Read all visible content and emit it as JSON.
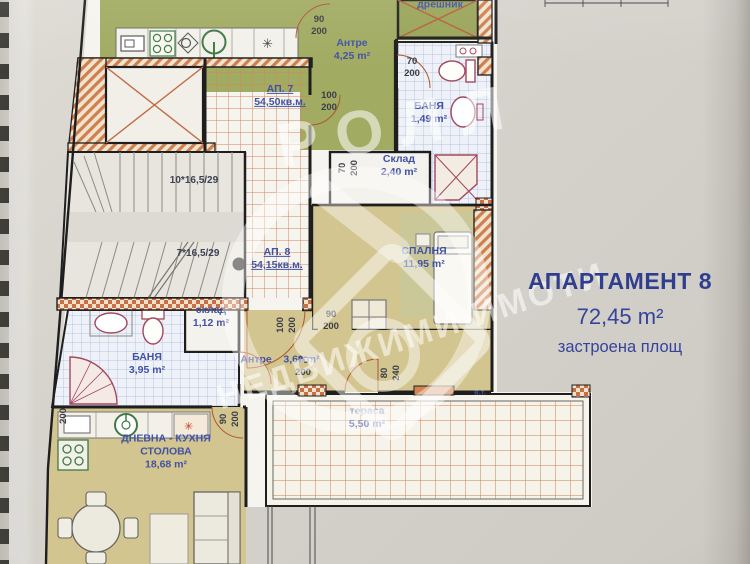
{
  "title_block": {
    "title": "АПАРТАМЕНТ 8",
    "area": "72,45 m²",
    "caption": "застроена площ"
  },
  "watermark": {
    "brand": "РОЛЛ",
    "tagline": "НЕДВИЖИМИ ИМОТИ"
  },
  "plan": {
    "icons": {
      "asterisk": "✳"
    },
    "room_labels": [
      {
        "name": "label-room-antre-ap7",
        "lines": [
          "Антре",
          "4,25 m²"
        ],
        "x": 352,
        "y": 50
      },
      {
        "name": "label-room-dreshnik",
        "lines": [
          "дрешник"
        ],
        "x": 440,
        "y": 5
      },
      {
        "name": "label-room-banya-ap7",
        "lines": [
          "БАНЯ",
          "1,49 m²"
        ],
        "x": 429,
        "y": 113
      },
      {
        "name": "label-ap7",
        "lines": [
          "АП. 7",
          "54,50кв.м."
        ],
        "x": 280,
        "y": 96,
        "u": true
      },
      {
        "name": "label-room-sklad-240",
        "lines": [
          "Склад",
          "2,40 m²"
        ],
        "x": 399,
        "y": 166
      },
      {
        "name": "label-ap8",
        "lines": [
          "АП. 8",
          "54,15кв.м."
        ],
        "x": 277,
        "y": 259,
        "u": true
      },
      {
        "name": "label-room-spalnya",
        "lines": [
          "СПАЛНЯ",
          "11,95 m²"
        ],
        "x": 424,
        "y": 258
      },
      {
        "name": "label-room-sklad-112",
        "lines": [
          "склад",
          "1,12 m²"
        ],
        "x": 211,
        "y": 317
      },
      {
        "name": "label-room-banya-ap8",
        "lines": [
          "БАНЯ",
          "3,95 m²"
        ],
        "x": 147,
        "y": 364
      },
      {
        "name": "label-room-antre-ap8",
        "lines": [
          "Антре    3,60 m²"
        ],
        "x": 280,
        "y": 360
      },
      {
        "name": "label-room-terasa",
        "lines": [
          "тераса",
          "5,50 m²"
        ],
        "x": 367,
        "y": 418,
        "faint": true
      },
      {
        "name": "label-room-dnevna",
        "lines": [
          "ДНЕВНА - КУХНЯ",
          "СТОЛОВА",
          "18,68 m²"
        ],
        "x": 166,
        "y": 452
      },
      {
        "name": "label-water-point",
        "lines": [
          "в.т."
        ],
        "x": 480,
        "y": 392,
        "small": true
      }
    ],
    "stair_labels": [
      {
        "name": "label-stairs-upper",
        "lines": [
          "10*16,5/29"
        ],
        "x": 194,
        "y": 181
      },
      {
        "name": "label-stairs-lower",
        "lines": [
          "7*16,5/29"
        ],
        "x": 198,
        "y": 254
      }
    ],
    "dim_labels": [
      {
        "name": "dim-door-90-200-top",
        "lines": [
          "90",
          "200"
        ],
        "x": 319,
        "y": 26
      },
      {
        "name": "dim-door-100-200",
        "lines": [
          "100",
          "200"
        ],
        "x": 329,
        "y": 102
      },
      {
        "name": "dim-door-70-200-bath7",
        "lines": [
          "70",
          "200"
        ],
        "x": 412,
        "y": 68
      },
      {
        "name": "dim-door-70-200-sklad",
        "lines": [
          "70",
          "200"
        ],
        "x": 349,
        "y": 168,
        "rot": -90
      },
      {
        "name": "dim-door-90-200-bedroom",
        "lines": [
          "90",
          "200"
        ],
        "x": 331,
        "y": 321
      },
      {
        "name": "dim-door-70-200-bath8",
        "lines": [
          "70",
          "200"
        ],
        "x": 303,
        "y": 367
      },
      {
        "name": "dim-door-100-200-entry",
        "lines": [
          "100",
          "200"
        ],
        "x": 287,
        "y": 325,
        "rot": -90
      },
      {
        "name": "dim-door-90-200-living",
        "lines": [
          "90",
          "200"
        ],
        "x": 230,
        "y": 419,
        "rot": -90
      },
      {
        "name": "dim-window-80-240",
        "lines": [
          "80",
          "240"
        ],
        "x": 391,
        "y": 373,
        "rot": -90
      },
      {
        "name": "dim-200-left",
        "lines": [
          "200"
        ],
        "x": 64,
        "y": 416,
        "rot": -90
      }
    ]
  }
}
